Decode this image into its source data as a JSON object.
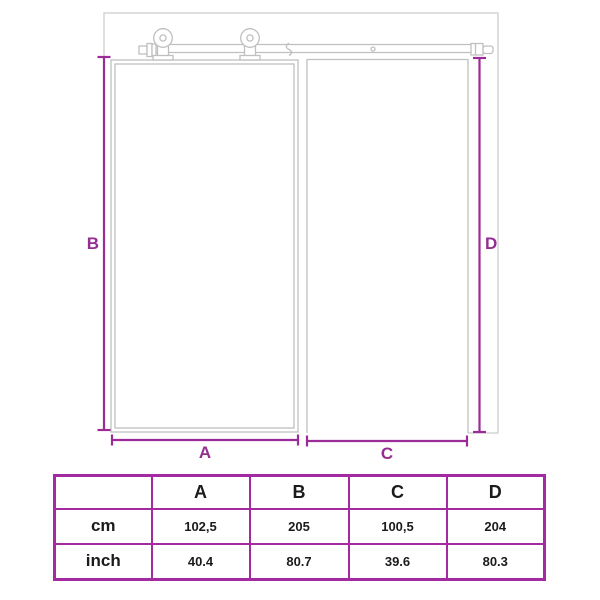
{
  "diagram": {
    "labels": {
      "a": "A",
      "b": "B",
      "c": "C",
      "d": "D"
    },
    "colors": {
      "dimension_line": "#9b2b97",
      "dimension_label": "#942e90",
      "drawing_line": "#bfbfbf",
      "wall_line": "#cccccc",
      "table_border": "#a32aa0"
    }
  },
  "table": {
    "columns": [
      "",
      "A",
      "B",
      "C",
      "D"
    ],
    "rows": [
      {
        "label": "cm",
        "values": [
          "102,5",
          "205",
          "100,5",
          "204"
        ]
      },
      {
        "label": "inch",
        "values": [
          "40.4",
          "80.7",
          "39.6",
          "80.3"
        ]
      }
    ]
  }
}
